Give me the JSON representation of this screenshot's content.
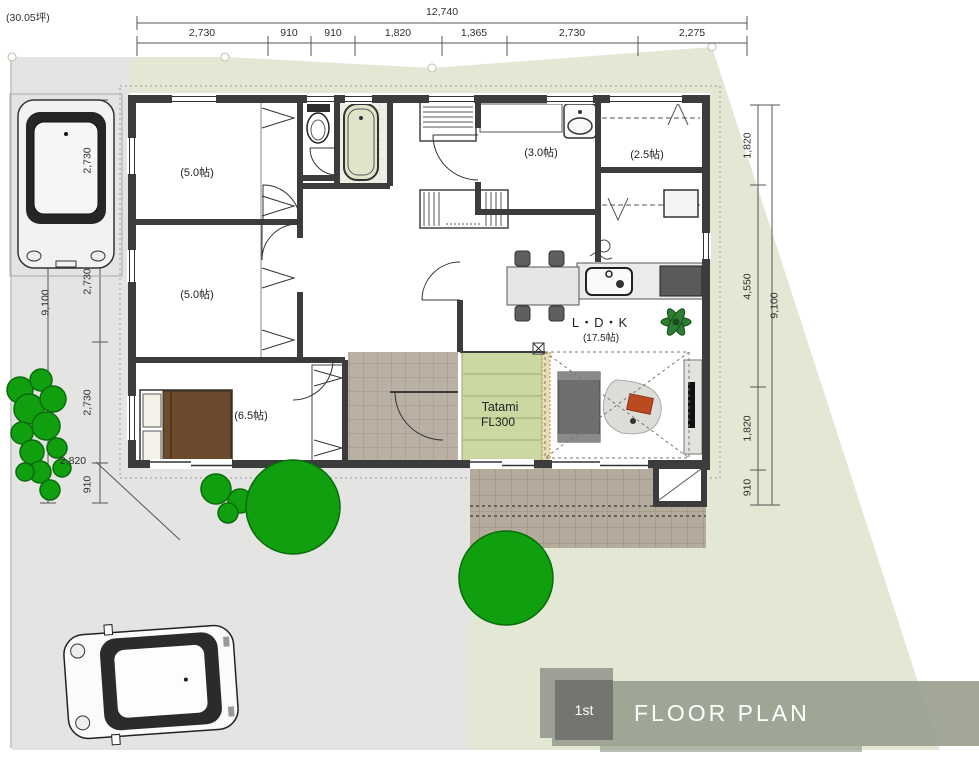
{
  "site": {
    "area_label": "(30.05坪)"
  },
  "banner": {
    "badge": "1st",
    "title": "FLOOR PLAN"
  },
  "dimensions": {
    "top": {
      "total": "12,740",
      "segments": [
        "2,730",
        "910",
        "910",
        "1,820",
        "1,365",
        "2,730",
        "2,275"
      ]
    },
    "left": {
      "total": "9,100",
      "segments": [
        "2,730",
        "2,730",
        "2,730",
        "910"
      ],
      "approach": "2,820"
    },
    "right": {
      "total": "9,100",
      "segments": [
        "1,820",
        "4,550",
        "1,820",
        "910"
      ]
    }
  },
  "rooms": {
    "bedroom_a": "(5.0帖)",
    "bedroom_b": "(5.0帖)",
    "master_bedroom": "(6.5帖)",
    "washroom": "(3.0帖)",
    "wic": "(2.5帖)",
    "ldk": "L・D・K",
    "ldk_size": "(17.5帖)",
    "tatami": "Tatami",
    "tatami_fl": "FL300"
  },
  "colors": {
    "yard": "#e2e8d4",
    "driveway": "#e4e4e3",
    "wall": "#3c3c3c",
    "tatami": "#ccd8a2",
    "tree": "#0f9f0f",
    "terrace_tile": "#b4ab9d",
    "banner": "#9aa08f",
    "badge": "#72746c",
    "cushion": "#bb4a22",
    "bed": "#6b4a2e"
  }
}
